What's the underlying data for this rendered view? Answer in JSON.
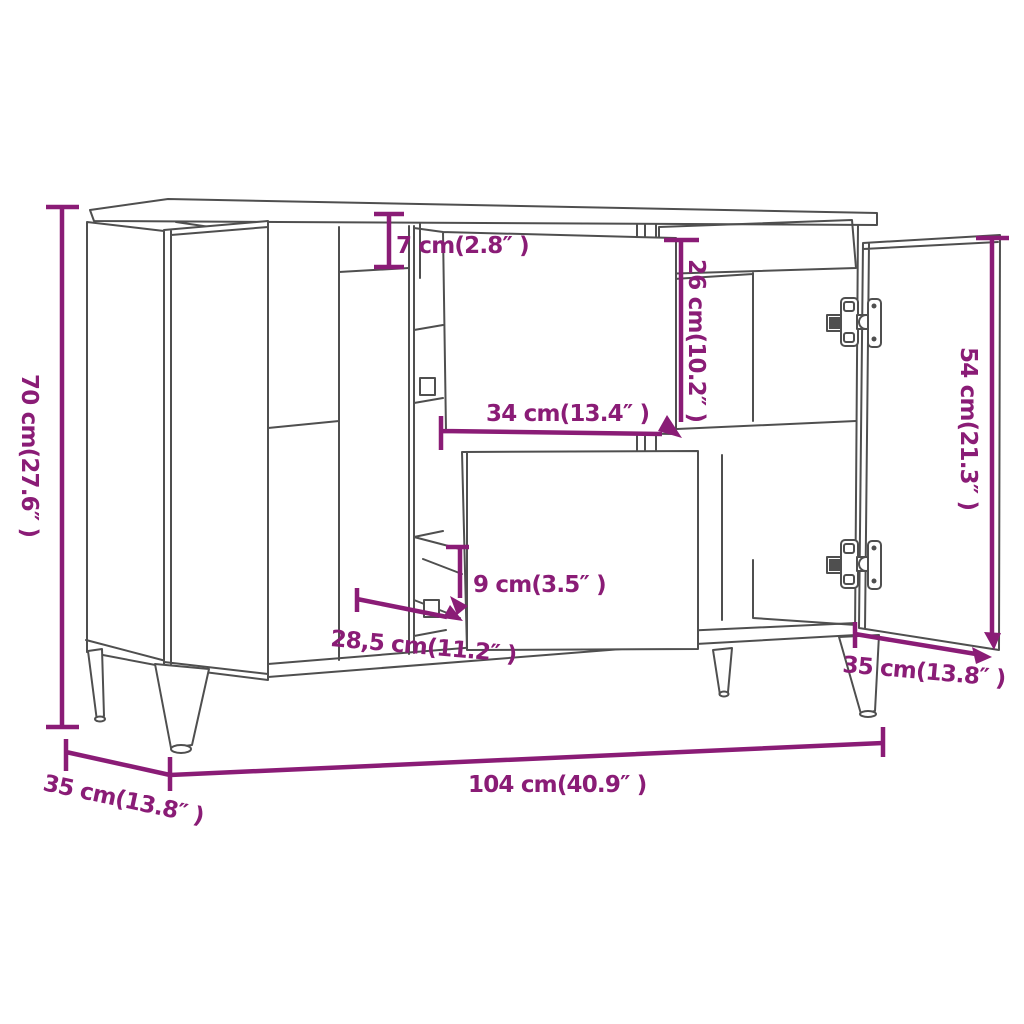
{
  "page": {
    "background": "#ffffff",
    "title": "Sideboard dimension diagram"
  },
  "diagram": {
    "product": "sideboard-with-doors-and-drawers",
    "accent_color": "#8a1c76",
    "line_color": "#4f4f4f",
    "dimensions": {
      "height": {
        "label": "70 cm(27.6″ )",
        "value_cm": 70,
        "value_in": 27.6,
        "orientation": "vertical-left"
      },
      "top_drawer_front": {
        "label": "7 cm(2.8″ )",
        "value_cm": 7,
        "value_in": 2.8,
        "orientation": "vertical"
      },
      "drawer_opening": {
        "label": "26 cm(10.2″ )",
        "value_cm": 26,
        "value_in": 10.2,
        "orientation": "vertical"
      },
      "drawer_width": {
        "label": "34 cm(13.4″ )",
        "value_cm": 34,
        "value_in": 13.4,
        "orientation": "horizontal"
      },
      "door_height": {
        "label": "54 cm(21.3″ )",
        "value_cm": 54,
        "value_in": 21.3,
        "orientation": "vertical-right"
      },
      "lower_drawer_front": {
        "label": "9 cm(3.5″ )",
        "value_cm": 9,
        "value_in": 3.5,
        "orientation": "vertical"
      },
      "drawer_depth": {
        "label": "28,5 cm(11.2″ )",
        "value_cm": 28.5,
        "value_in": 11.2,
        "orientation": "diagonal"
      },
      "depth": {
        "label": "35 cm(13.8″ )",
        "value_cm": 35,
        "value_in": 13.8,
        "orientation": "diagonal-left"
      },
      "width": {
        "label": "104 cm(40.9″ )",
        "value_cm": 104,
        "value_in": 40.9,
        "orientation": "horizontal-bottom"
      },
      "door_width": {
        "label": "35 cm(13.8″ )",
        "value_cm": 35,
        "value_in": 13.8,
        "orientation": "diagonal-right"
      }
    }
  }
}
